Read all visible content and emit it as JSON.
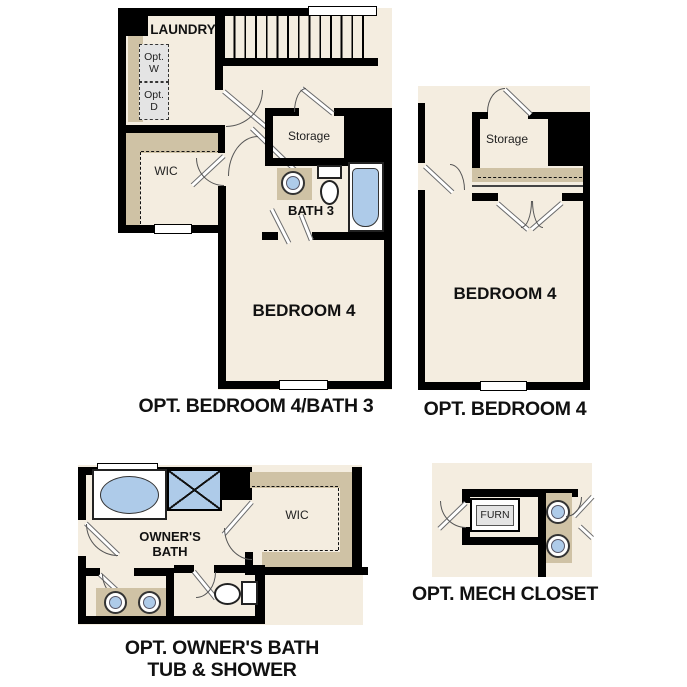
{
  "page": {
    "background": "#ffffff",
    "type": "floor-plan-options-sheet"
  },
  "palette": {
    "wall": "#000000",
    "floor": "#f4ede0",
    "shelf": "#cfc2a5",
    "fixture_blue": "#aecbe9",
    "appliance_gray": "#e4e4e4",
    "text": "#111111"
  },
  "plans": [
    {
      "id": "opt-bedroom4-bath3",
      "caption": "OPT. BEDROOM 4/BATH 3",
      "rooms": {
        "laundry": "LAUNDRY",
        "wic": "WIC",
        "storage": "Storage",
        "bath3": "BATH 3",
        "bedroom4": "BEDROOM 4"
      },
      "fixtures": {
        "washer": "Opt. W",
        "dryer": "Opt. D"
      }
    },
    {
      "id": "opt-bedroom4",
      "caption": "OPT. BEDROOM 4",
      "rooms": {
        "storage": "Storage",
        "bedroom4": "BEDROOM 4"
      }
    },
    {
      "id": "opt-owners-bath",
      "caption_line1": "OPT. OWNER'S BATH",
      "caption_line2": "TUB & SHOWER",
      "rooms": {
        "owners_bath": "OWNER'S BATH",
        "wic": "WIC"
      }
    },
    {
      "id": "opt-mech-closet",
      "caption": "OPT. MECH CLOSET",
      "fixtures": {
        "furnace": "FURN"
      }
    }
  ]
}
